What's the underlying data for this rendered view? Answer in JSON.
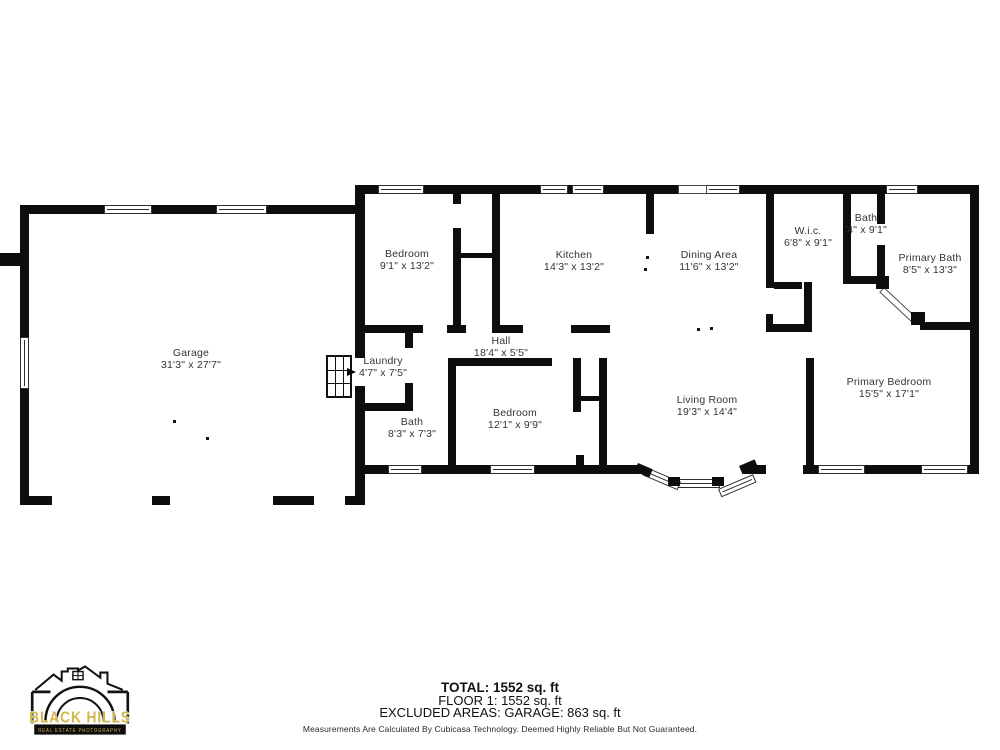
{
  "floorplan": {
    "rooms": [
      {
        "name": "Garage",
        "dims": "31'3\" x 27'7\"",
        "cx": 191,
        "cy": 359
      },
      {
        "name": "Bedroom",
        "dims": "9'1\" x 13'2\"",
        "cx": 407,
        "cy": 260
      },
      {
        "name": "Kitchen",
        "dims": "14'3\" x 13'2\"",
        "cx": 574,
        "cy": 261
      },
      {
        "name": "Dining Area",
        "dims": "11'6\" x 13'2\"",
        "cx": 709,
        "cy": 261
      },
      {
        "name": "W.i.c.",
        "dims": "6'8\" x 9'1\"",
        "cx": 808,
        "cy": 237
      },
      {
        "name": "Bath",
        "dims": "'4\" x 9'1\"",
        "cx": 866,
        "cy": 224
      },
      {
        "name": "Primary Bath",
        "dims": "8'5\" x 13'3\"",
        "cx": 930,
        "cy": 264
      },
      {
        "name": "Hall",
        "dims": "18'4\" x 5'5\"",
        "cx": 501,
        "cy": 347
      },
      {
        "name": "Laundry",
        "dims": "4'7\" x 7'5\"",
        "cx": 383,
        "cy": 367
      },
      {
        "name": "Bath",
        "dims": "8'3\" x 7'3\"",
        "cx": 412,
        "cy": 428
      },
      {
        "name": "Bedroom",
        "dims": "12'1\" x 9'9\"",
        "cx": 515,
        "cy": 419
      },
      {
        "name": "Living Room",
        "dims": "19'3\" x 14'4\"",
        "cx": 707,
        "cy": 406
      },
      {
        "name": "Primary Bedroom",
        "dims": "15'5\" x 17'1\"",
        "cx": 889,
        "cy": 388
      }
    ]
  },
  "footer": {
    "total": "TOTAL: 1552 sq. ft",
    "floor": "FLOOR 1: 1552 sq. ft",
    "excluded": "EXCLUDED AREAS: GARAGE: 863 sq. ft",
    "disclaimer": "Measurements Are Calculated By Cubicasa Technology. Deemed Highly Reliable But Not Guaranteed."
  },
  "logo": {
    "line1": "BLACK HILLS",
    "line2": "REAL ESTATE PHOTOGRAPHY",
    "accent_color": "#d2b74b"
  }
}
